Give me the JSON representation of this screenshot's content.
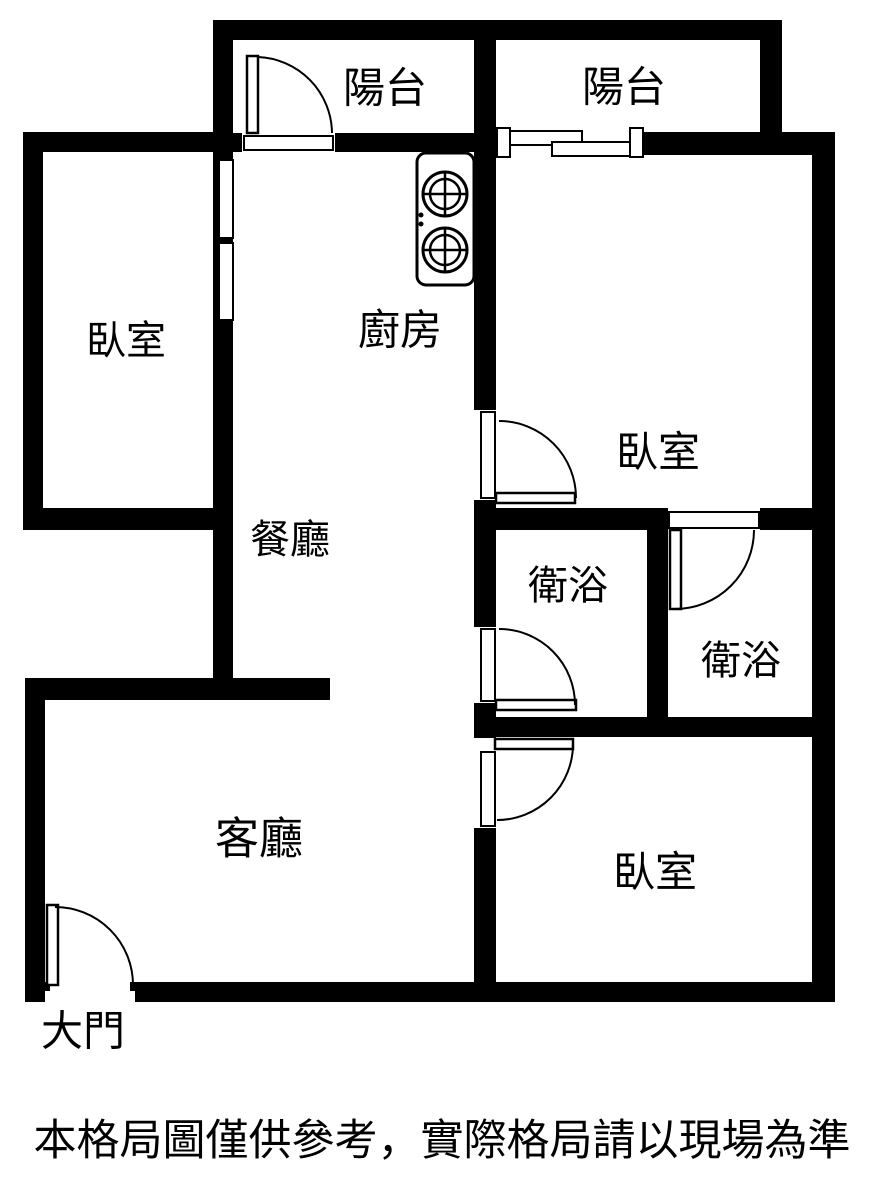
{
  "colors": {
    "wall": "#000000",
    "background": "#ffffff",
    "text": "#000000"
  },
  "rooms": {
    "balcony_left": {
      "label": "陽台"
    },
    "balcony_right": {
      "label": "陽台"
    },
    "bedroom_left": {
      "label": "臥室"
    },
    "bedroom_right": {
      "label": "臥室"
    },
    "bedroom_bottom": {
      "label": "臥室"
    },
    "kitchen": {
      "label": "廚房"
    },
    "dining": {
      "label": "餐廳"
    },
    "bathroom_left": {
      "label": "衛浴"
    },
    "bathroom_right": {
      "label": "衛浴"
    },
    "living": {
      "label": "客廳"
    },
    "entrance": {
      "label": "大門"
    }
  },
  "icons": {
    "stove": "gas-stove-icon",
    "door": "door-swing-icon",
    "window": "sliding-window-icon"
  },
  "footer": {
    "disclaimer": "本格局圖僅供參考，實際格局請以現場為準"
  }
}
